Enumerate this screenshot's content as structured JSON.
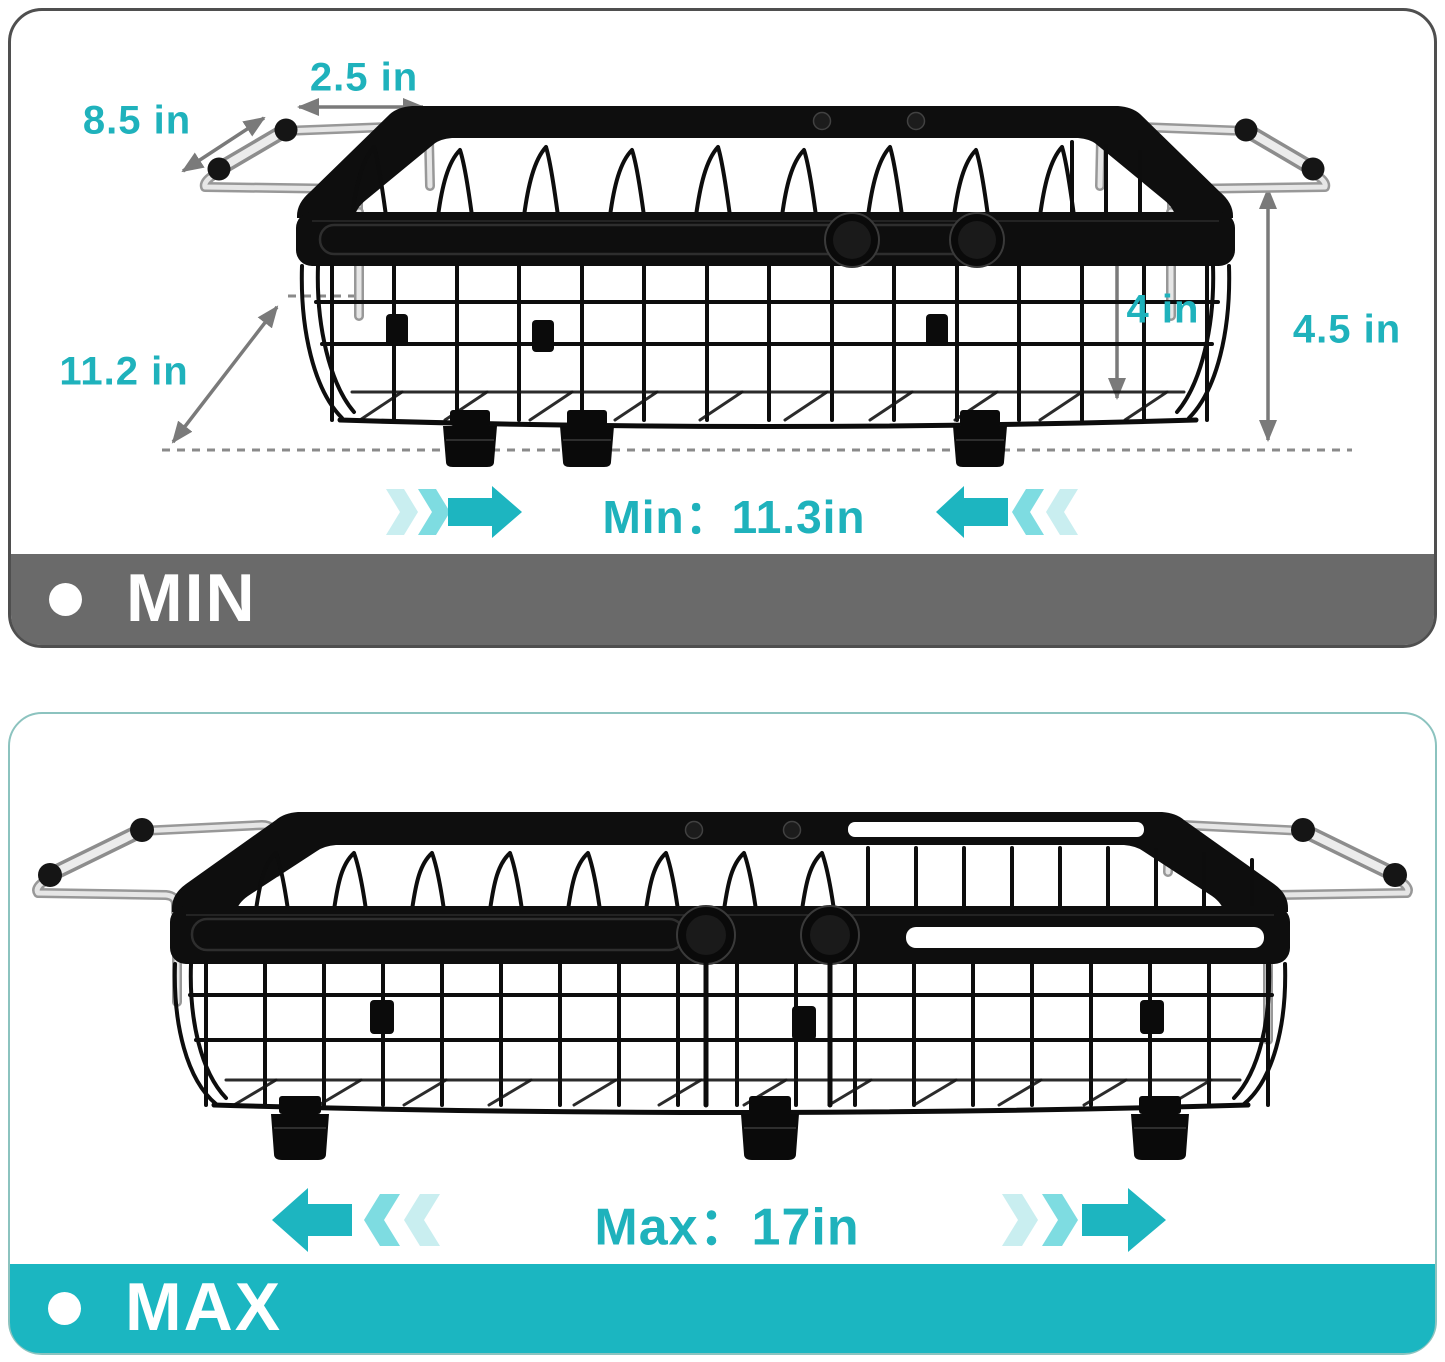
{
  "min_panel": {
    "banner_label": "MIN",
    "dim_labels": {
      "grip_length": "8.5 in",
      "extension": "2.5 in",
      "diagonal": "11.2 in",
      "basket_depth": "4 in",
      "overall_height": "4.5 in"
    },
    "range_label": "Min：11.3in"
  },
  "max_panel": {
    "banner_label": "MAX",
    "range_label": "Max：17in"
  },
  "colors": {
    "teal": "#1db5c0",
    "teal_mid": "#7edce1",
    "teal_light": "#c9eef0",
    "text_teal": "#1fb2bc",
    "banner_gray": "#6a6a6a",
    "banner_teal": "#1bb6c1",
    "dim_gray": "#7a7a7a",
    "card_border_gray": "#4f4f4f",
    "card_border_teal": "#8cc3bf"
  }
}
